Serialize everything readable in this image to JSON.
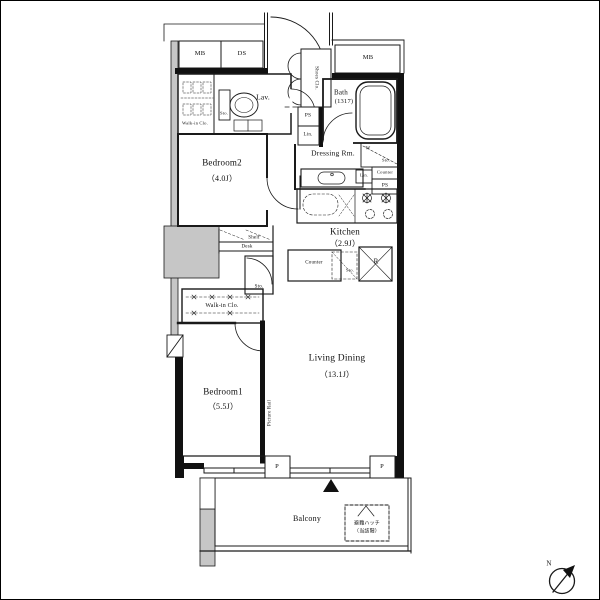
{
  "title": "apartment-floor-plan",
  "colors": {
    "line": "#1a1a1a",
    "void_fill": "#c6c6c6",
    "background": "#ffffff"
  },
  "labels": {
    "mb_left": "MB",
    "ds": "DS",
    "mb_right": "MB",
    "shoes_closet": "Shoes Clo.",
    "walkin_closet_top": "Walk-in Clo.",
    "sto_lavatory": "Sto.",
    "lavatory": "Lav.",
    "bath_name": "Bath",
    "bath_size": "(1317)",
    "ps_hall": "PS",
    "lin_hall": "Lin.",
    "dressing_room": "Dressing Rm.",
    "washer": "W",
    "sto_washer": "Sto.",
    "counter_right": "Counter",
    "lin_right": "Lin.",
    "ps_right": "PS",
    "bedroom2_name": "Bedroom2",
    "bedroom2_size": "（4.0J）",
    "kitchen_name": "Kitchen",
    "kitchen_size": "（2.9J）",
    "counter_island": "Counter",
    "sto_counter": "Sto.",
    "refrigerator": "R",
    "shelf": "Shelf",
    "desk": "Desk",
    "sto_middle": "Sto.",
    "walkin_closet_bottom": "Walk-in Clo.",
    "bedroom1_name": "Bedroom1",
    "bedroom1_size": "（5.5J）",
    "living_dining_name": "Living Dining",
    "living_dining_size": "（13.1J）",
    "picture_rail": "Picture Rail",
    "pillar_left": "P",
    "pillar_right": "P",
    "balcony": "Balcony",
    "hatch_line1": "避難ハッチ",
    "hatch_line2": "（当該階）",
    "north": "N"
  }
}
